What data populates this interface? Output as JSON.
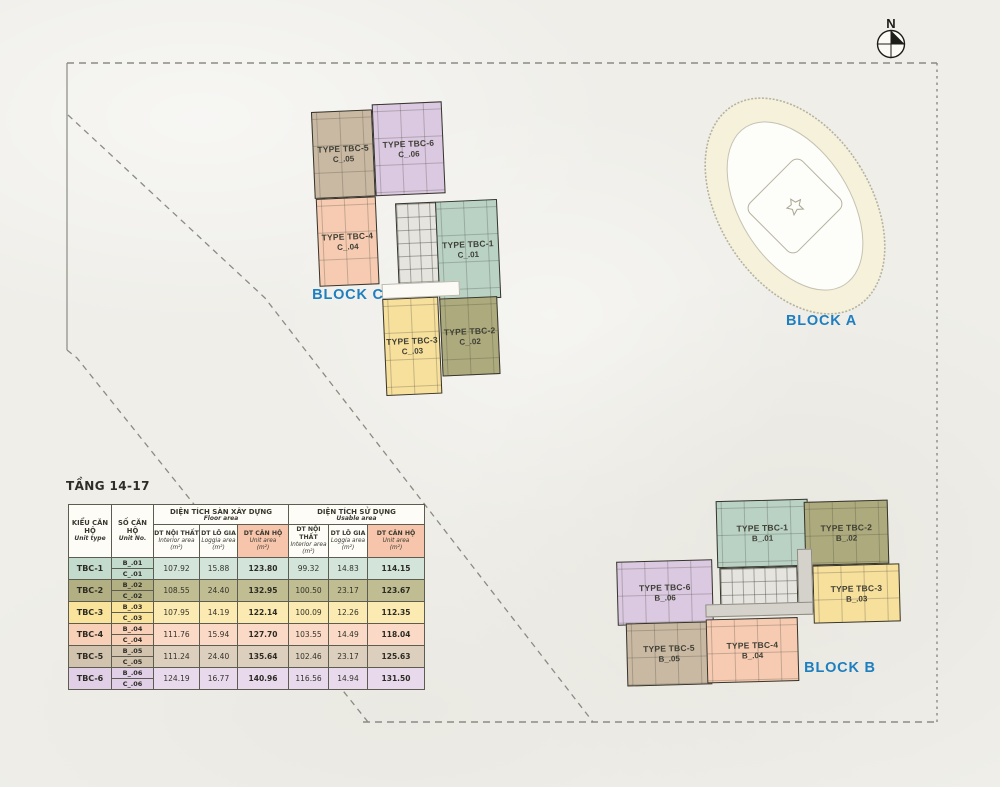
{
  "north": {
    "label": "N"
  },
  "colors": {
    "accent_blue": "#1d7fc0",
    "tbc1_teal": "#b9d2c4",
    "tbc2_olive": "#adab7d",
    "tbc3_yellow": "#f7df9c",
    "tbc4_peach": "#f6cbb2",
    "tbc5_tan": "#c9b9a3",
    "tbc6_purple": "#dbc8e1",
    "header_highlight": "#f6c5ab",
    "background": "#efeee9"
  },
  "blocks": {
    "a": {
      "label": "BLOCK A"
    },
    "b": {
      "label": "BLOCK B",
      "units": [
        {
          "type": "TYPE TBC-1",
          "no": "B_.01"
        },
        {
          "type": "TYPE TBC-2",
          "no": "B_.02"
        },
        {
          "type": "TYPE TBC-3",
          "no": "B_.03"
        },
        {
          "type": "TYPE TBC-4",
          "no": "B_.04"
        },
        {
          "type": "TYPE TBC-5",
          "no": "B_.05"
        },
        {
          "type": "TYPE TBC-6",
          "no": "B_.06"
        }
      ]
    },
    "c": {
      "label": "BLOCK C",
      "units": [
        {
          "type": "TYPE TBC-1",
          "no": "C_.01"
        },
        {
          "type": "TYPE TBC-2",
          "no": "C_.02"
        },
        {
          "type": "TYPE TBC-3",
          "no": "C_.03"
        },
        {
          "type": "TYPE TBC-4",
          "no": "C_.04"
        },
        {
          "type": "TYPE TBC-5",
          "no": "C_.05"
        },
        {
          "type": "TYPE TBC-6",
          "no": "C_.06"
        }
      ]
    }
  },
  "table": {
    "title": "TẦNG 14-17",
    "headers": {
      "unit_type": {
        "vi": "KIỂU CĂN HỘ",
        "en": "Unit type"
      },
      "unit_no": {
        "vi": "SỐ CĂN HỘ",
        "en": "Unit No."
      },
      "group_floor": {
        "vi": "DIỆN TÍCH SÀN XÂY DỰNG",
        "en": "Floor area"
      },
      "group_usable": {
        "vi": "DIỆN TÍCH SỬ DỤNG",
        "en": "Usable area"
      },
      "sub_interior": {
        "vi": "DT NỘI THẤT",
        "en": "Interior area",
        "unit": "(m²)"
      },
      "sub_loggia": {
        "vi": "DT LÔ GIA",
        "en": "Loggia area",
        "unit": "(m²)"
      },
      "sub_unit": {
        "vi": "DT CĂN HỘ",
        "en": "Unit area",
        "unit": "(m²)"
      }
    },
    "rows": [
      {
        "type": "TBC-1",
        "no_b": "B_.01",
        "no_c": "C_.01",
        "floor_interior": "107.92",
        "floor_loggia": "15.88",
        "floor_unit": "123.80",
        "usable_interior": "99.32",
        "usable_loggia": "14.83",
        "usable_unit": "114.15"
      },
      {
        "type": "TBC-2",
        "no_b": "B_.02",
        "no_c": "C_.02",
        "floor_interior": "108.55",
        "floor_loggia": "24.40",
        "floor_unit": "132.95",
        "usable_interior": "100.50",
        "usable_loggia": "23.17",
        "usable_unit": "123.67"
      },
      {
        "type": "TBC-3",
        "no_b": "B_.03",
        "no_c": "C_.03",
        "floor_interior": "107.95",
        "floor_loggia": "14.19",
        "floor_unit": "122.14",
        "usable_interior": "100.09",
        "usable_loggia": "12.26",
        "usable_unit": "112.35"
      },
      {
        "type": "TBC-4",
        "no_b": "B_.04",
        "no_c": "C_.04",
        "floor_interior": "111.76",
        "floor_loggia": "15.94",
        "floor_unit": "127.70",
        "usable_interior": "103.55",
        "usable_loggia": "14.49",
        "usable_unit": "118.04"
      },
      {
        "type": "TBC-5",
        "no_b": "B_.05",
        "no_c": "C_.05",
        "floor_interior": "111.24",
        "floor_loggia": "24.40",
        "floor_unit": "135.64",
        "usable_interior": "102.46",
        "usable_loggia": "23.17",
        "usable_unit": "125.63"
      },
      {
        "type": "TBC-6",
        "no_b": "B_.06",
        "no_c": "C_.06",
        "floor_interior": "124.19",
        "floor_loggia": "16.77",
        "floor_unit": "140.96",
        "usable_interior": "116.56",
        "usable_loggia": "14.94",
        "usable_unit": "131.50"
      }
    ]
  }
}
